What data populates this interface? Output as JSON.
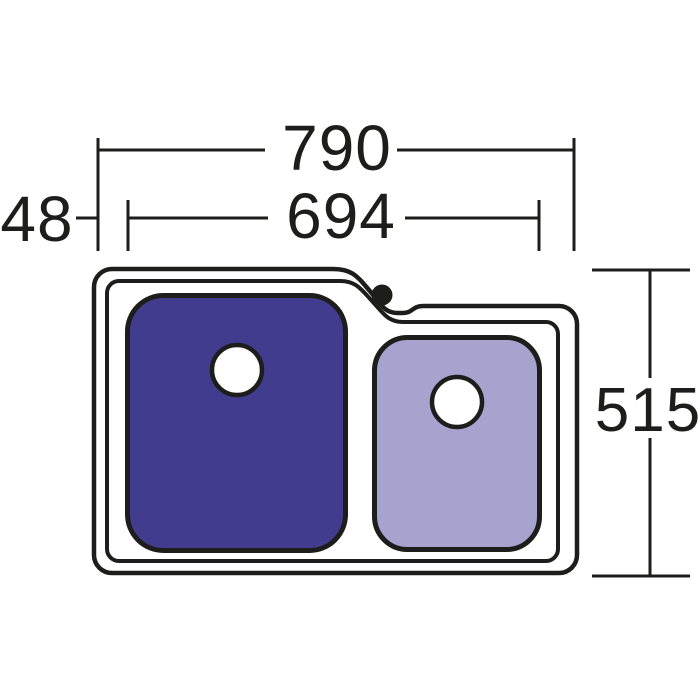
{
  "diagram": {
    "name": "double-bowl-sink-top-view-dimension-drawing",
    "background": "#ffffff",
    "colors": {
      "line": "#1d1d1b",
      "large_bowl": "#423c8e",
      "small_bowl": "#a8a2cf",
      "drain": "#ffffff",
      "tap_hole": "#1d1d1b"
    },
    "labels": {
      "overall_width": "790",
      "bowl_span_width": "694",
      "left_offset": "48",
      "overall_depth": "515"
    }
  }
}
